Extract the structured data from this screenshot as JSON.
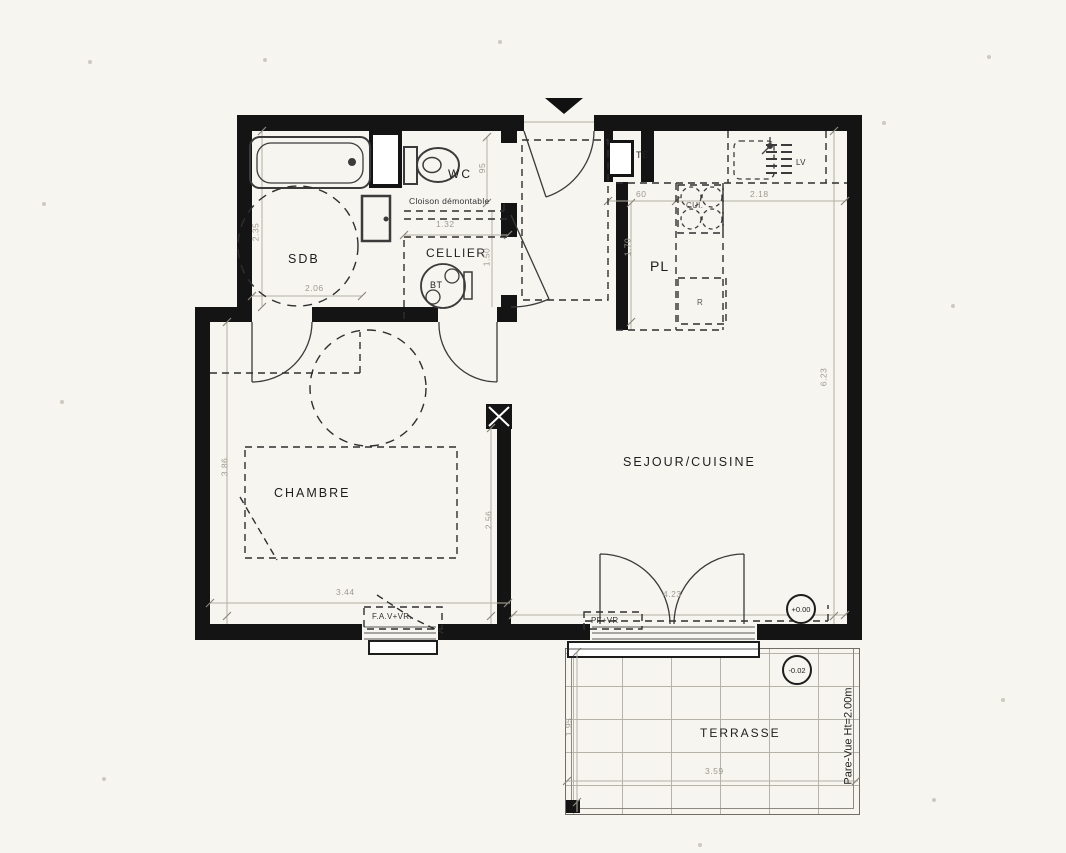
{
  "rooms": {
    "sdb": "SDB",
    "wc": "WC",
    "cellier": "CELLIER",
    "chambre": "CHAMBRE",
    "sejour": "SEJOUR/CUISINE",
    "terrasse": "TERRASSE"
  },
  "equipment": {
    "bt": "BT",
    "te": "TE",
    "pl": "PL",
    "lv": "LV",
    "cui": "CUI.",
    "refrigerator": "R"
  },
  "annotations": {
    "cloison": "Cloison démontable",
    "fav": "F.A.V+VR.",
    "pf": "PF+VR",
    "pare_vue": "Pare-Vue Ht=2.00m",
    "level_interior": "+0.00",
    "level_terrace": "-0.02"
  },
  "dimensions": {
    "sdb_h": "2.35",
    "sdb_w": "2.06",
    "wc_w": "95",
    "cloison_w": "1.32",
    "cellier_h": "1.50",
    "te_w": "60",
    "kitchen_w": "2.18",
    "pl_h": "1.70",
    "chambre_h": "3.86",
    "chambre_passage": "2.56",
    "chambre_w": "3.44",
    "sejour_w": "4.23",
    "sejour_h": "6.23",
    "terrasse_h": "1.95",
    "terrasse_w": "3.59"
  },
  "colors": {
    "wall": "#141414",
    "paper": "#f7f5f0",
    "line": "#3b3b3b",
    "dim_text": "#9d9a8f"
  }
}
